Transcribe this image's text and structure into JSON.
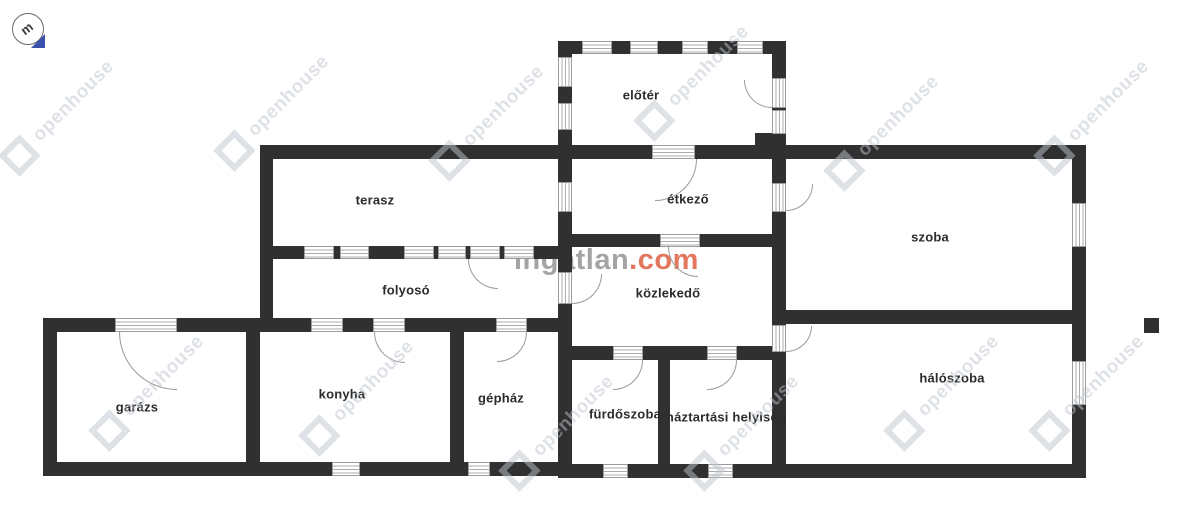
{
  "compass": {
    "letter": "m"
  },
  "rooms": {
    "eloter": {
      "label": "előtér"
    },
    "terasz": {
      "label": "terasz"
    },
    "etkezo": {
      "label": "étkező"
    },
    "szoba": {
      "label": "szoba"
    },
    "folyoso": {
      "label": "folyosó"
    },
    "kozlekedo": {
      "label": "közlekedő"
    },
    "garazs": {
      "label": "garázs"
    },
    "konyha": {
      "label": "konyha"
    },
    "gephaz": {
      "label": "gépház"
    },
    "furdoszoba": {
      "label": "fürdőszoba"
    },
    "haztartasi": {
      "label": "háztartási helyiség"
    },
    "haloszoba": {
      "label": "hálószoba"
    }
  },
  "watermarks": {
    "site_name": "ingatlan",
    "site_tld": ".com",
    "agency": "openhouse"
  },
  "colors": {
    "wall": "#303030",
    "site_gray": "#949494",
    "site_orange": "#db5535",
    "agency_watermark": "#bec5cd",
    "compass_blue": "#3c50ae"
  }
}
